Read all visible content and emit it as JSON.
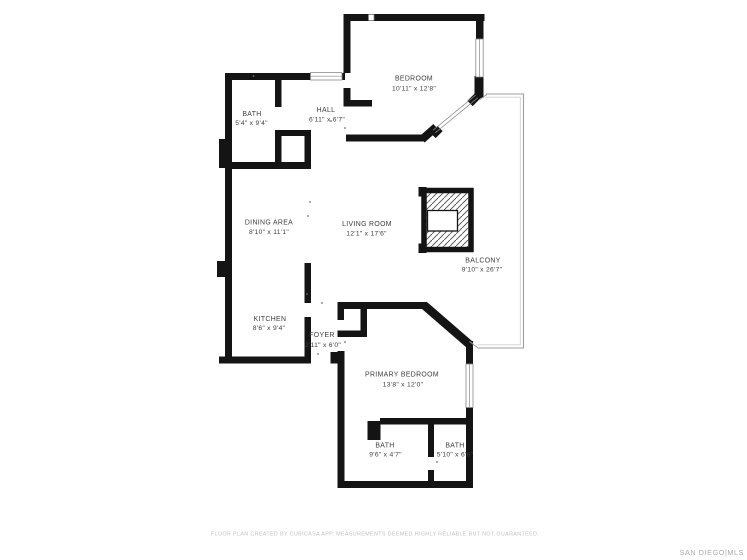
{
  "plan": {
    "rooms": [
      {
        "name": "BEDROOM",
        "dims": "10'11\" x 12'8\""
      },
      {
        "name": "BATH",
        "dims": "5'4\" x 9'4\""
      },
      {
        "name": "HALL",
        "dims": "6'11\" x 6'7\""
      },
      {
        "name": "DINING AREA",
        "dims": "8'10\" x 11'1\""
      },
      {
        "name": "LIVING ROOM",
        "dims": "12'1\" x 17'6\""
      },
      {
        "name": "BALCONY",
        "dims": "9'10\" x 26'7\""
      },
      {
        "name": "KITCHEN",
        "dims": "8'6\" x 9'4\""
      },
      {
        "name": "FOYER",
        "dims": "2'11\" x 6'0\""
      },
      {
        "name": "PRIMARY BEDROOM",
        "dims": "13'8\" x 12'0\""
      },
      {
        "name": "BATH",
        "dims": "9'6\" x 4'7\""
      },
      {
        "name": "BATH",
        "dims": "5'10\" x 6'6\""
      }
    ]
  },
  "footer": {
    "disclaimer": "FLOOR PLAN CREATED BY CUBICASA APP. MEASUREMENTS DEEMED HIGHLY RELIABLE BUT NOT GUARANTEED.",
    "watermark": "SAN DIEGO|MLS"
  },
  "colors": {
    "wall": "#141414",
    "window_frame": "#8a8a8a",
    "railing": "#9e9e9e",
    "label": "#3c3c3c",
    "muted": "#c2c2c2"
  }
}
